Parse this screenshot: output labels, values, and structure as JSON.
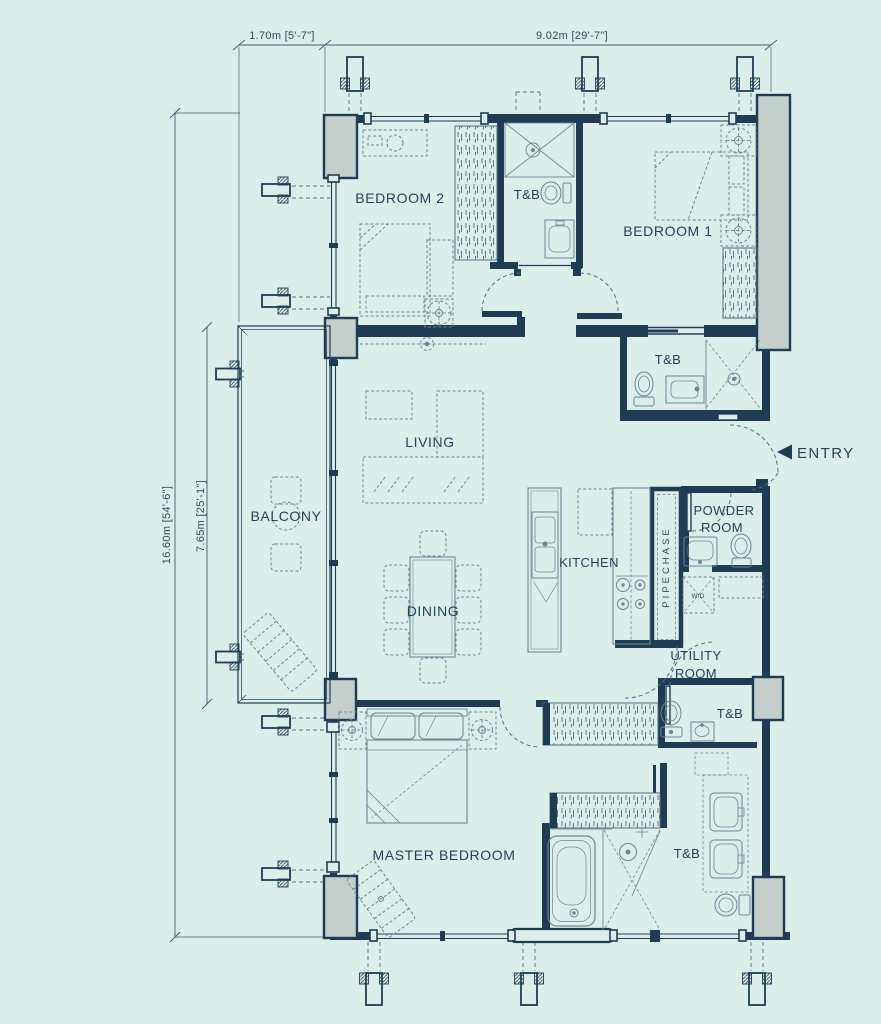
{
  "page": {
    "background": "#dceeea"
  },
  "palette": {
    "wall": "#1f3c55",
    "column_fill": "#c4cecb",
    "furniture_line": "#6a8795",
    "dimension_line": "#3f5d6e",
    "label_text": "#24435a"
  },
  "dimensions": {
    "top_small": "1.70m [5'-7\"]",
    "top_large": "9.02m [29'-7\"]",
    "side_full": "16.60m [54'-6\"]",
    "side_balcony": "7.65m [25'-1\"]"
  },
  "rooms": {
    "bedroom2": "BEDROOM 2",
    "tb_shared": "T&B",
    "bedroom1": "BEDROOM 1",
    "tb_bedroom1": "T&B",
    "balcony": "BALCONY",
    "living": "LIVING",
    "kitchen": "KITCHEN",
    "powder_line1": "POWDER",
    "powder_line2": "ROOM",
    "dining": "DINING",
    "utility_line1": "UTILITY",
    "utility_line2": "ROOM",
    "tb_utility": "T&B",
    "master_bedroom": "MASTER BEDROOM",
    "tb_master": "T&B",
    "pipechase": "PIPECHASE",
    "washer_dryer": "W/D"
  },
  "entry": {
    "label": "ENTRY"
  }
}
